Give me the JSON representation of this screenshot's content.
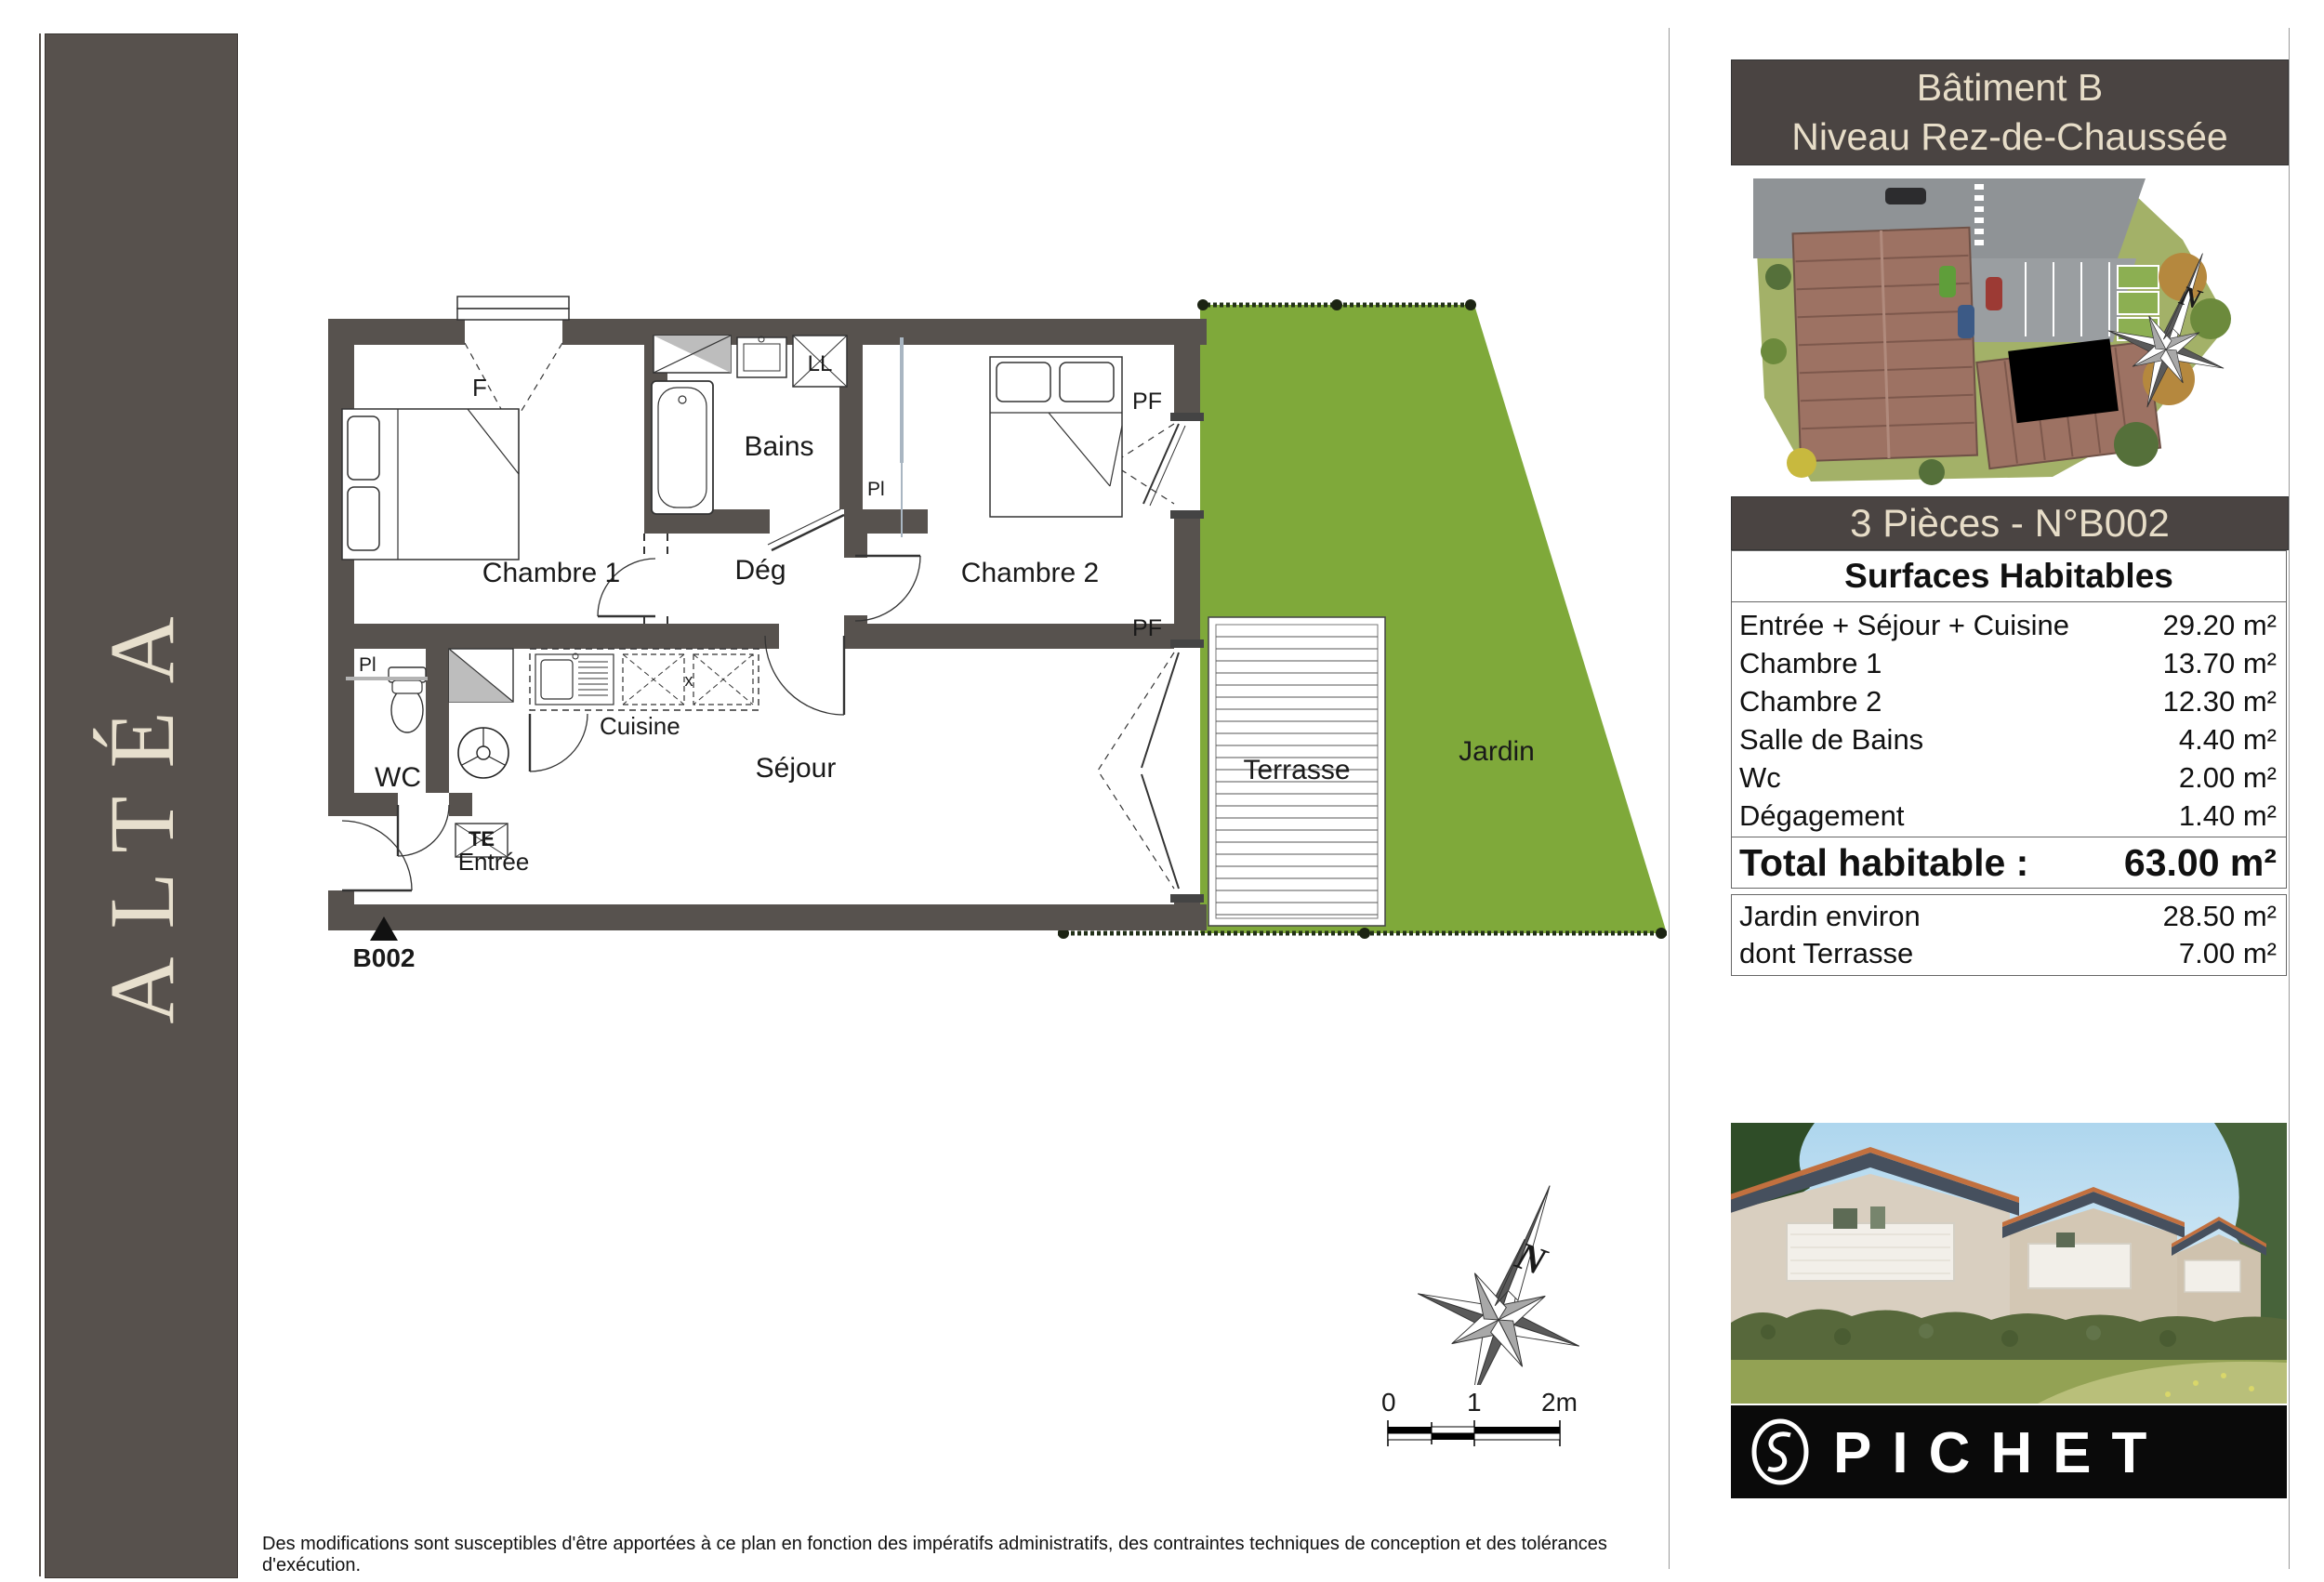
{
  "colors": {
    "wall": "#57524e",
    "panel_dark": "#4a4442",
    "cream": "#e7ddc8",
    "garden_green": "#7fa93a",
    "logo_black": "#0a0a0a"
  },
  "sidebar": {
    "project": "ALTÉA"
  },
  "header": {
    "line1": "Bâtiment B",
    "line2": "Niveau Rez-de-Chaussée"
  },
  "unit": {
    "title": "3 Pièces - N°B002"
  },
  "surfaces": {
    "title": "Surfaces Habitables",
    "rows": [
      {
        "label": "Entrée + Séjour + Cuisine",
        "value": "29.20 m²"
      },
      {
        "label": "Chambre 1",
        "value": "13.70 m²"
      },
      {
        "label": "Chambre 2",
        "value": "12.30 m²"
      },
      {
        "label": "Salle de Bains",
        "value": "4.40 m²"
      },
      {
        "label": "Wc",
        "value": "2.00 m²"
      },
      {
        "label": "Dégagement",
        "value": "1.40 m²"
      }
    ],
    "total": {
      "label": "Total habitable :",
      "value": "63.00 m²"
    },
    "outdoor": [
      {
        "label": "Jardin environ",
        "value": "28.50 m²"
      },
      {
        "label": "dont Terrasse",
        "value": "7.00 m²"
      }
    ]
  },
  "plan": {
    "labels": {
      "f": "F",
      "ll": "LL",
      "bains": "Bains",
      "pl": "Pl",
      "deg": "Dég",
      "chambre1": "Chambre 1",
      "chambre2": "Chambre 2",
      "pf": "PF",
      "cuisine": "Cuisine",
      "wc": "WC",
      "te": "TE",
      "sejour": "Séjour",
      "entree": "Entrée",
      "terrasse": "Terrasse",
      "jardin": "Jardin",
      "unit_ref": "B002"
    },
    "compass_n": "N",
    "scalebar": {
      "t0": "0",
      "t1": "1",
      "t2": "2m"
    }
  },
  "footer": {
    "disclaimer": "Des modifications sont susceptibles d'être apportées à ce plan en fonction des impératifs administratifs, des contraintes techniques de conception et des tolérances d'exécution."
  },
  "logo": {
    "brand": "PICHET"
  }
}
